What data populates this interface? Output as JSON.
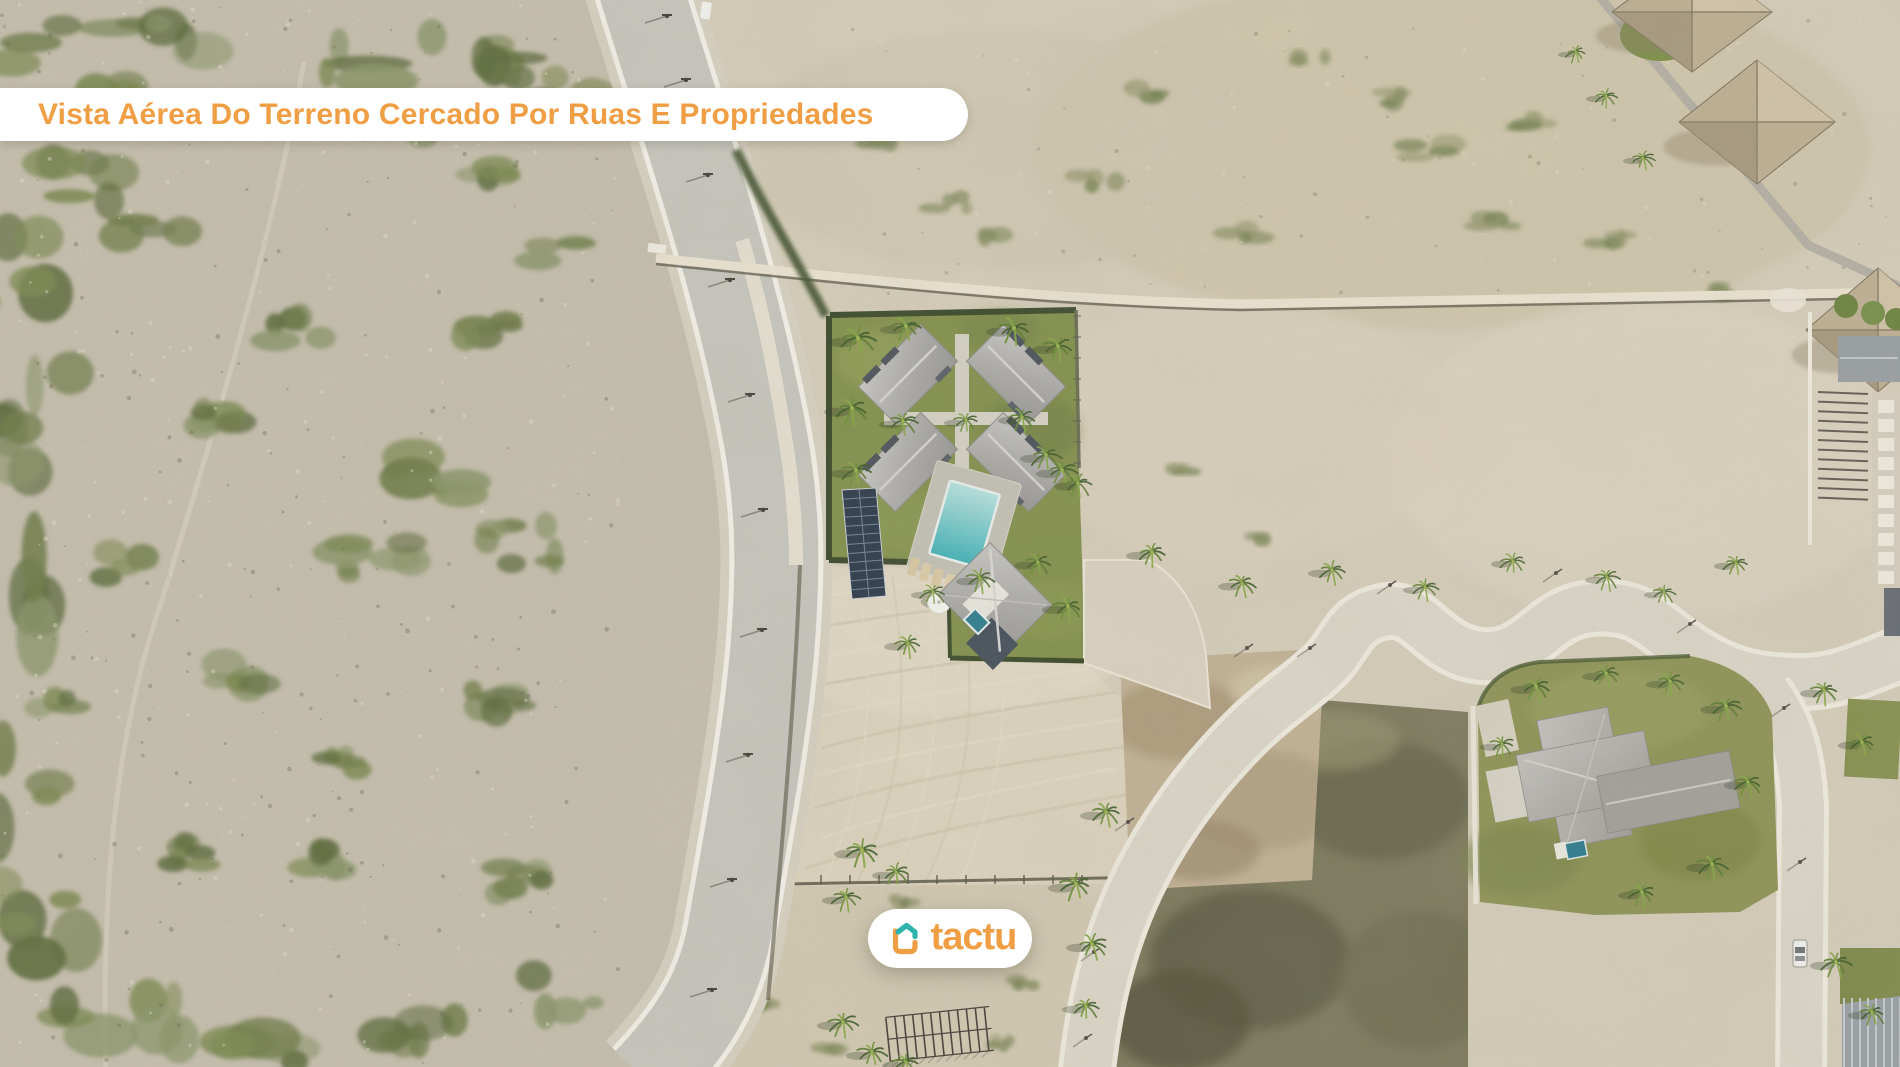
{
  "overlay": {
    "title": "Vista Aérea Do Terreno Cercado Por Ruas E Propriedades",
    "brand": "tactu"
  },
  "colors": {
    "accent_orange": "#F09E44",
    "logo_teal": "#2FB4AD",
    "banner_background": "#FFFFFF"
  },
  "scene": {
    "type": "aerial-drone-photo",
    "labels": {
      "featured_property": "walled villa compound with four thatched villas, pool and solar array",
      "land_plot": "cleared sand plot bordered by streets",
      "roads": [
        "curved asphalt road",
        "winding concrete street"
      ],
      "neighbor_property": "villa with cross-shaped gray roof and small pool",
      "terrain": "coastal dune scrubland with palm trees and thatched palapas"
    }
  }
}
